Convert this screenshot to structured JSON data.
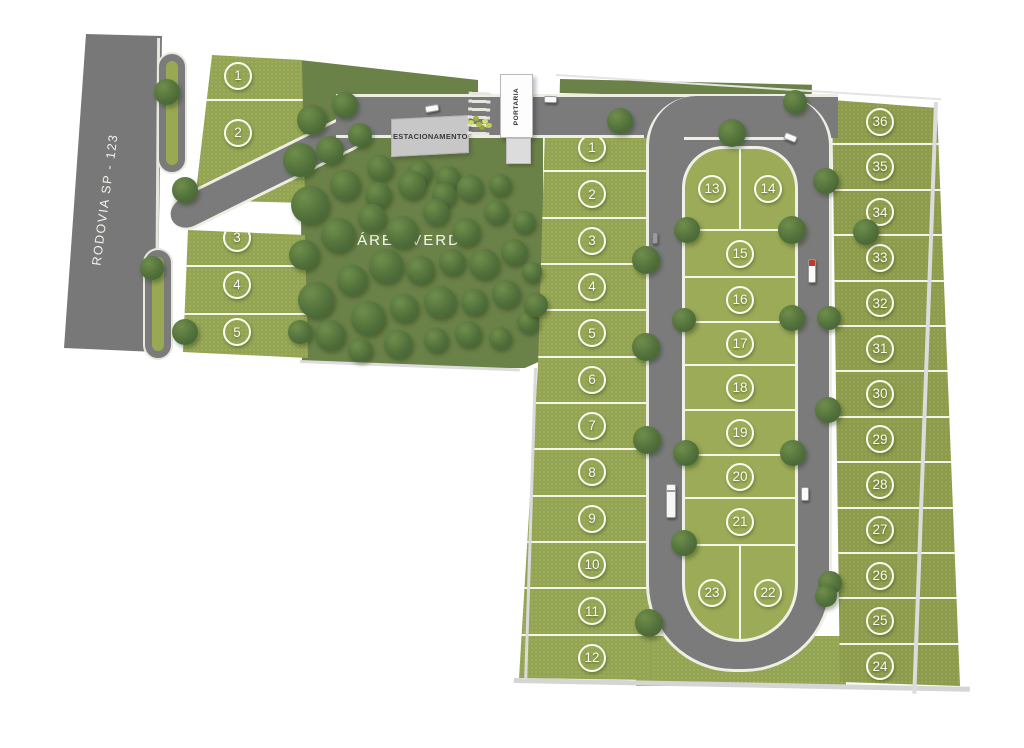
{
  "labels": {
    "highway": "RODOVIA SP - 123",
    "green_area": "ÁREA VERDE",
    "parking": "ESTACIONAMENTO",
    "gatehouse": "PORTARIA"
  },
  "lots": {
    "left_block": [
      "1",
      "2",
      "3",
      "4",
      "5"
    ],
    "middle_block": [
      "1",
      "2",
      "3",
      "4",
      "5",
      "6",
      "7",
      "8",
      "9",
      "10",
      "11",
      "12"
    ],
    "island_block": {
      "top": [
        "13",
        "14"
      ],
      "mid": [
        "15",
        "16",
        "17",
        "18",
        "19",
        "20",
        "21"
      ],
      "bottom": [
        "23",
        "22"
      ]
    },
    "right_block": [
      "36",
      "35",
      "34",
      "33",
      "32",
      "31",
      "30",
      "29",
      "28",
      "27",
      "26",
      "25",
      "24"
    ]
  },
  "colors": {
    "road": "#7b7b7b",
    "grass": "#9aab57",
    "green_area": "#6a8148",
    "tree": "#4f6e3a",
    "curb": "#eeeee4",
    "lot_line": "#fcfcf2",
    "parking_fill": "#c7c7c7",
    "building": "#fdfdfd"
  }
}
